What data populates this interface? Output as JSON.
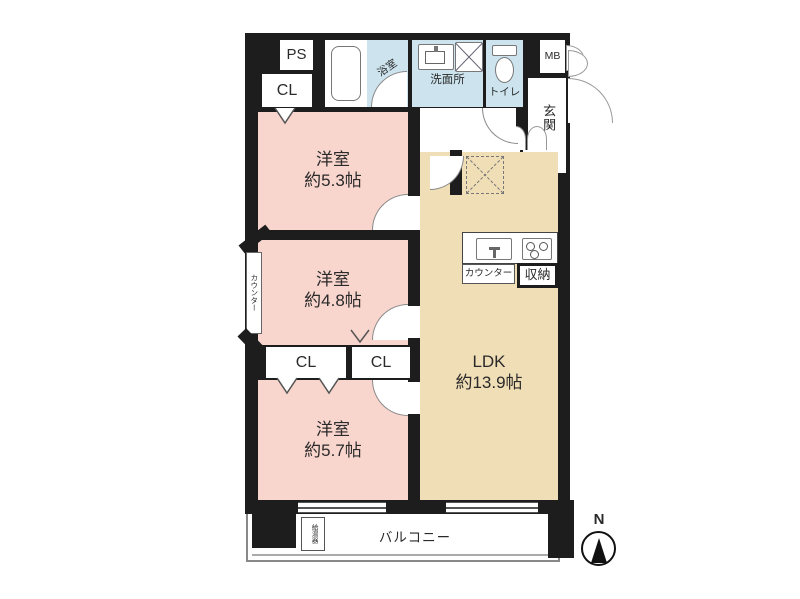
{
  "floorplan": {
    "compass": {
      "north": "N"
    },
    "utility": {
      "ps": "PS",
      "cl_top": "CL",
      "mb": "MB",
      "sb": "SB"
    },
    "wet_area": {
      "bath": "浴室",
      "washroom": "洗面所",
      "toilet": "トイレ"
    },
    "entrance": {
      "label": "玄関"
    },
    "bedrooms": [
      {
        "name": "洋室",
        "size": "約5.3帖"
      },
      {
        "name": "洋室",
        "size": "約4.8帖"
      },
      {
        "name": "洋室",
        "size": "約5.7帖"
      }
    ],
    "ldk": {
      "name": "LDK",
      "size": "約13.9帖"
    },
    "kitchen": {
      "counter": "カウンター",
      "storage": "収納"
    },
    "side_counter": "カウンター",
    "closets": {
      "left": "CL",
      "right": "CL"
    },
    "balcony": "バルコニー",
    "water_heater": "給湯器",
    "colors": {
      "wall": "#1d1d1d",
      "bedroom_pink": "#f8d5cd",
      "ldk_tan": "#f0deb6",
      "water_blue": "#cde4ef"
    }
  }
}
